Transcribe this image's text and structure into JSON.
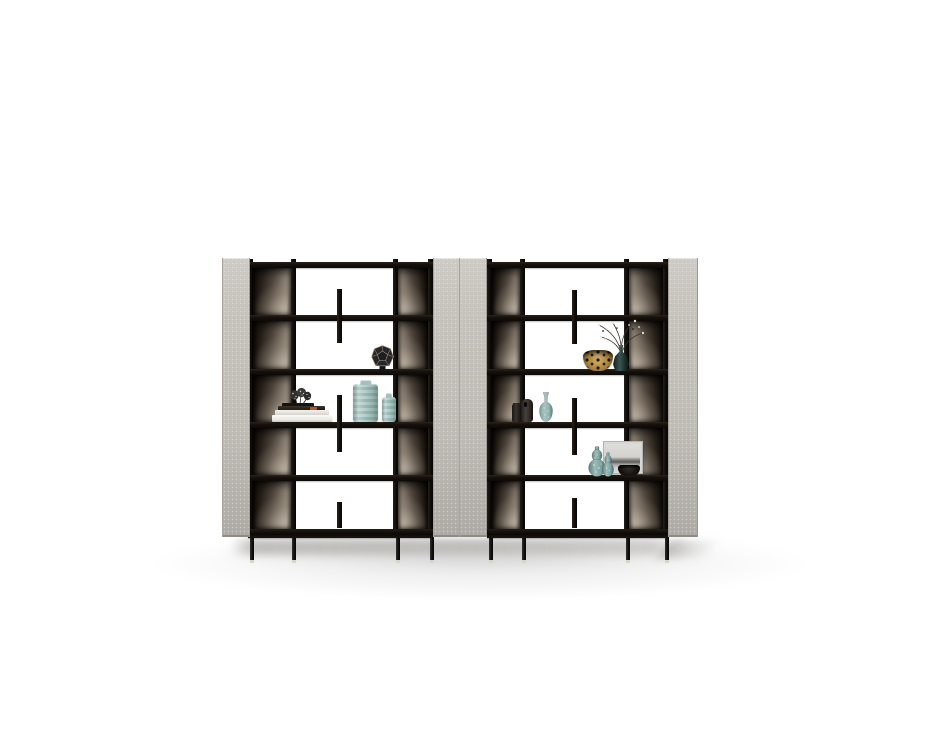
{
  "scene": {
    "type": "furniture-product-photo",
    "subject": "pair of open etagere bookshelf units with side panels and decor objects",
    "background_color": "#ffffff",
    "floor_shadow_color": "#bcbab7",
    "palette": {
      "side_panel_fabric": "#c7c3bd",
      "frame_black": "#15100d",
      "back_panel_bronze_dark": "#241d17",
      "back_panel_bronze_light": "#a99e90",
      "teal_glass": "#9fbebc",
      "gold_accent": "#b39a6a"
    },
    "units": [
      {
        "position": "left",
        "shelf_count": 6,
        "side_panels": 2,
        "back_panel_finish": "smoked bronze gradient",
        "decor": [
          {
            "name": "faceted-vase",
            "shelf": 3,
            "colors": [
              "#23252f",
              "#b39a6a"
            ]
          },
          {
            "name": "book-stack",
            "shelf": 4,
            "colors": [
              "#f2f1ee",
              "#262019",
              "#b05a2a"
            ]
          },
          {
            "name": "spiky-figurine",
            "shelf": 4,
            "colors": [
              "#303030",
              "#dddddd"
            ]
          },
          {
            "name": "ribbed-vase-large",
            "shelf": 4,
            "color": "#a9c6c3"
          },
          {
            "name": "ribbed-vase-small",
            "shelf": 4,
            "color": "#a9c6c3"
          }
        ]
      },
      {
        "position": "right",
        "shelf_count": 6,
        "side_panels": 2,
        "back_panel_finish": "smoked bronze gradient",
        "decor": [
          {
            "name": "leopard-bowl",
            "shelf": 3,
            "colors": [
              "#c59d56",
              "#1a130b"
            ]
          },
          {
            "name": "branch-vase",
            "shelf": 3,
            "colors": [
              "#2c4540",
              "#e8e4da"
            ]
          },
          {
            "name": "dark-vase-small",
            "shelf": 4,
            "color": "#2e2a27"
          },
          {
            "name": "dark-vase-large",
            "shelf": 4,
            "color": "#3a3532"
          },
          {
            "name": "genie-bottle-vase",
            "shelf": 4,
            "color": "#8fb2ae"
          },
          {
            "name": "framed-artwork",
            "shelf": 5,
            "colors": [
              "#d6d6d4",
              "#5f5e5a"
            ]
          },
          {
            "name": "gourd-vase-large",
            "shelf": 5,
            "color": "#7ea4a3"
          },
          {
            "name": "gourd-vase-small",
            "shelf": 5,
            "color": "#7ea4a3"
          },
          {
            "name": "dark-bowl",
            "shelf": 5,
            "color": "#14100d"
          }
        ]
      }
    ]
  }
}
